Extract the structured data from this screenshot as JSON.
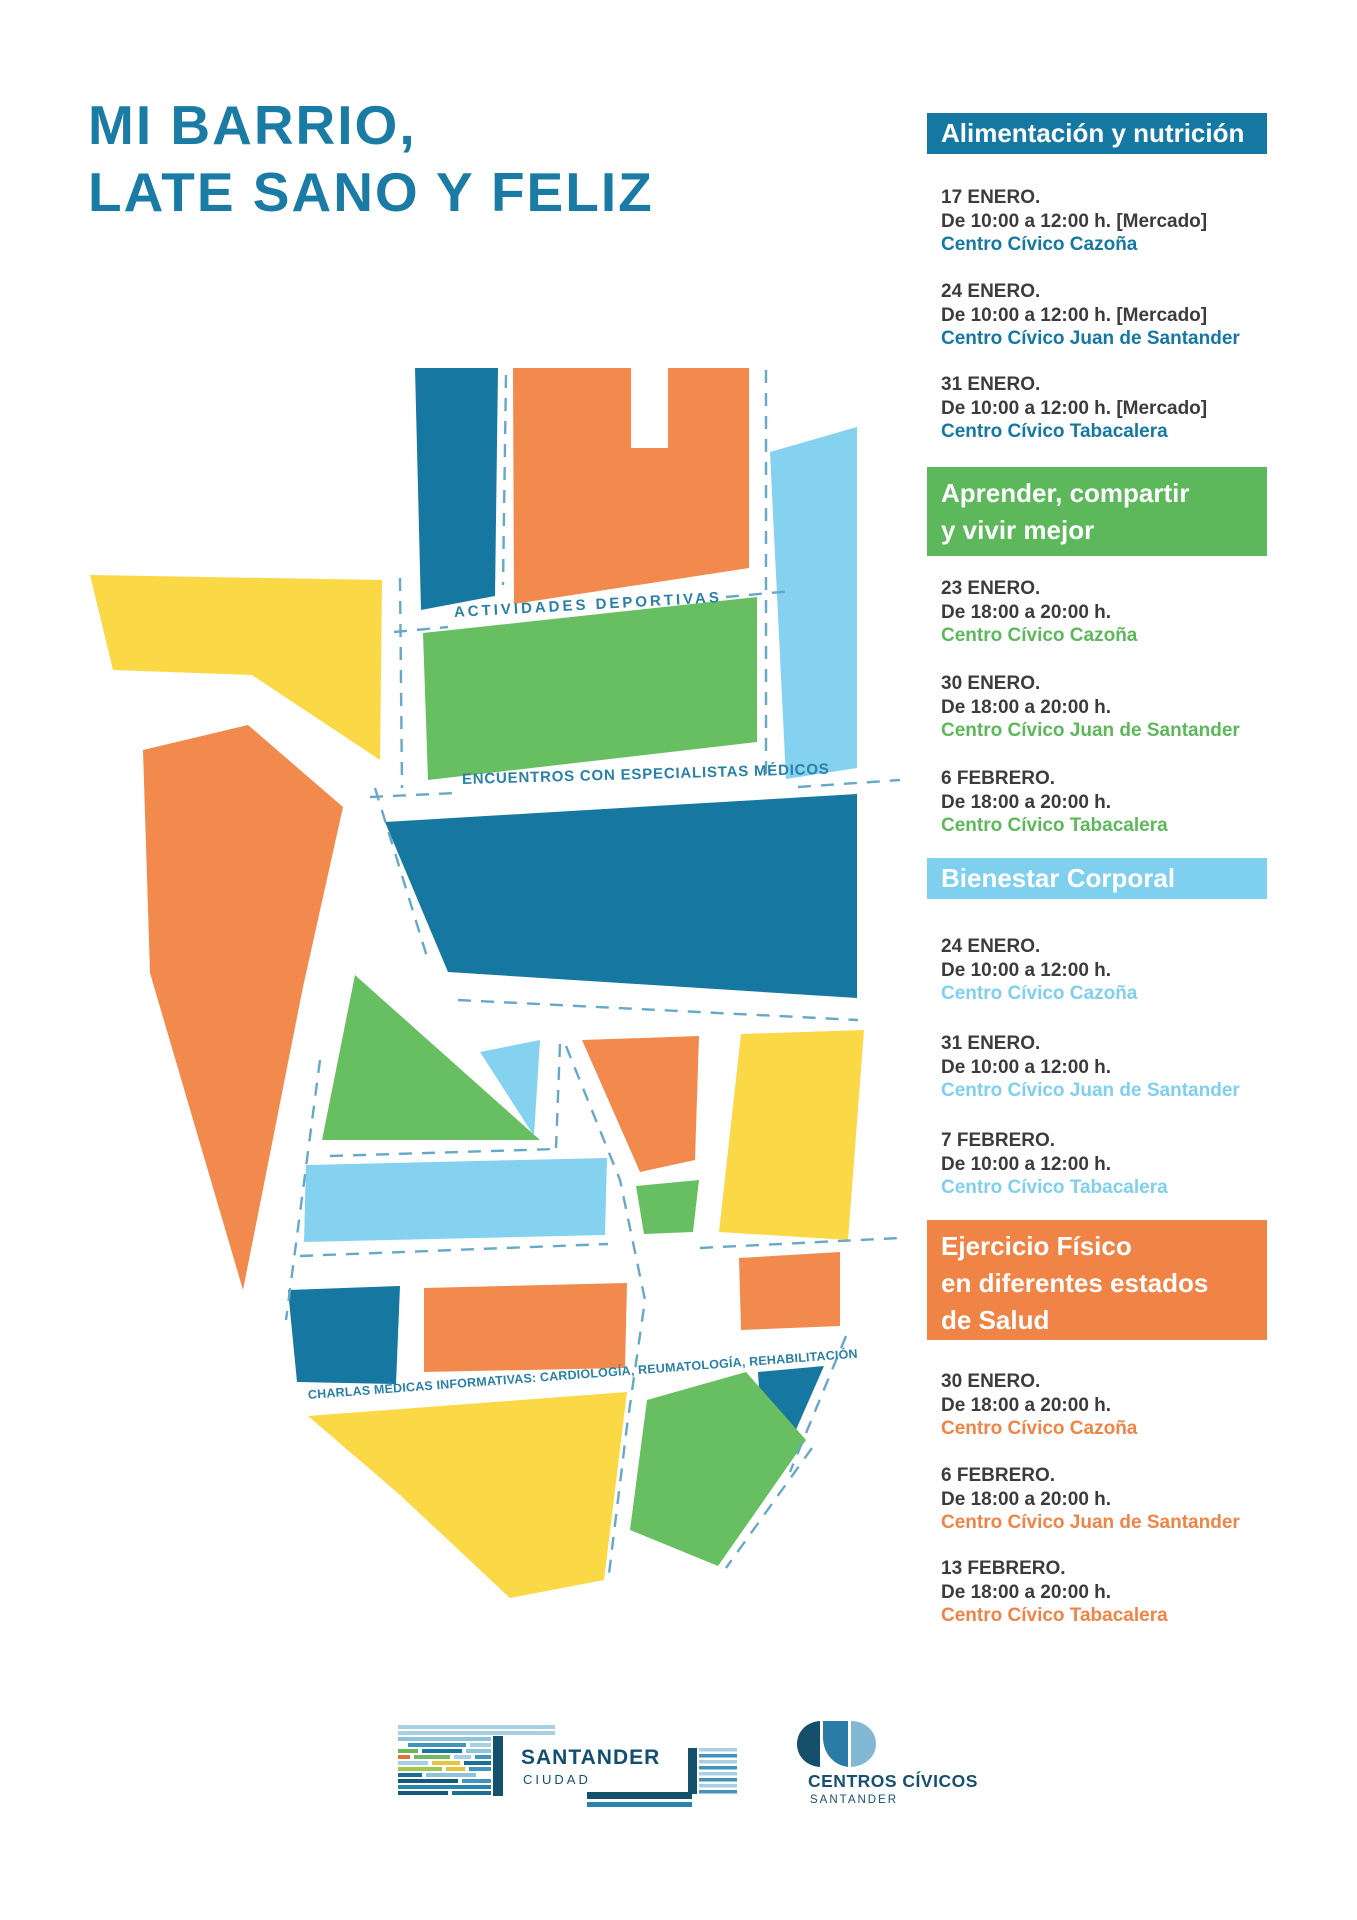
{
  "title": {
    "line1": "MI BARRIO,",
    "line2": "LATE SANO Y FELIZ"
  },
  "palette": {
    "teal": "#1678a1",
    "orange": "#f18a4c",
    "yellow": "#fbd845",
    "green": "#68bf62",
    "light_blue": "#85d2f0",
    "street_dash": "#66a9c7",
    "title_text": "#1a7ca4",
    "body_text": "#3c3c3c"
  },
  "map": {
    "labels": [
      {
        "id": "actividades",
        "text": "ACTIVIDADES DEPORTIVAS"
      },
      {
        "id": "encuentros",
        "text": "ENCUENTROS CON ESPECIALISTAS MÉDICOS"
      },
      {
        "id": "charlas",
        "text": "CHARLAS MÉDICAS INFORMATIVAS: CARDIOLOGÍA, REUMATOLOGÍA, REHABILITACIÓN"
      }
    ]
  },
  "schedule": {
    "sections": [
      {
        "id": "alimentacion",
        "color": "#1478a2",
        "title_lines": [
          "Alimentación y nutrición"
        ],
        "entries": [
          {
            "date": "17 ENERO.",
            "time": "De 10:00 a 12:00 h. [Mercado]",
            "place": "Centro Cívico Cazoña"
          },
          {
            "date": "24 ENERO.",
            "time": "De 10:00 a 12:00 h. [Mercado]",
            "place": "Centro Cívico Juan de Santander"
          },
          {
            "date": "31 ENERO.",
            "time": "De 10:00 a 12:00 h. [Mercado]",
            "place": "Centro Cívico Tabacalera"
          }
        ]
      },
      {
        "id": "aprender",
        "color": "#5cb85a",
        "title_lines": [
          "Aprender, compartir",
          "y vivir mejor"
        ],
        "entries": [
          {
            "date": "23 ENERO.",
            "time": "De 18:00 a 20:00 h.",
            "place": "Centro Cívico Cazoña"
          },
          {
            "date": "30 ENERO.",
            "time": "De 18:00 a 20:00 h.",
            "place": "Centro Cívico Juan de Santander"
          },
          {
            "date": "6 FEBRERO.",
            "time": "De 18:00 a 20:00 h.",
            "place": "Centro Cívico Tabacalera"
          }
        ]
      },
      {
        "id": "bienestar",
        "color": "#7fcfef",
        "title_lines": [
          "Bienestar Corporal"
        ],
        "entries": [
          {
            "date": "24 ENERO.",
            "time": "De 10:00 a 12:00 h.",
            "place": "Centro Cívico Cazoña"
          },
          {
            "date": "31 ENERO.",
            "time": "De 10:00 a 12:00 h.",
            "place": "Centro Cívico Juan de Santander"
          },
          {
            "date": "7 FEBRERO.",
            "time": "De 10:00 a 12:00 h.",
            "place": "Centro Cívico Tabacalera"
          }
        ]
      },
      {
        "id": "ejercicio",
        "color": "#ef8446",
        "title_lines": [
          "Ejercicio Físico",
          "en diferentes estados",
          "de Salud"
        ],
        "entries": [
          {
            "date": "30 ENERO.",
            "time": "De 18:00 a 20:00 h.",
            "place": "Centro Cívico Cazoña"
          },
          {
            "date": "6 FEBRERO.",
            "time": "De 18:00 a 20:00 h.",
            "place": "Centro Cívico Juan de Santander"
          },
          {
            "date": "13 FEBRERO.",
            "time": "De 18:00 a 20:00 h.",
            "place": "Centro Cívico Tabacalera"
          }
        ]
      }
    ]
  },
  "footer": {
    "santander_logo": {
      "name": "SANTANDER",
      "sub": "CIUDAD"
    },
    "centros_logo": {
      "name": "CENTROS CÍVICOS",
      "sub": "SANTANDER"
    }
  }
}
